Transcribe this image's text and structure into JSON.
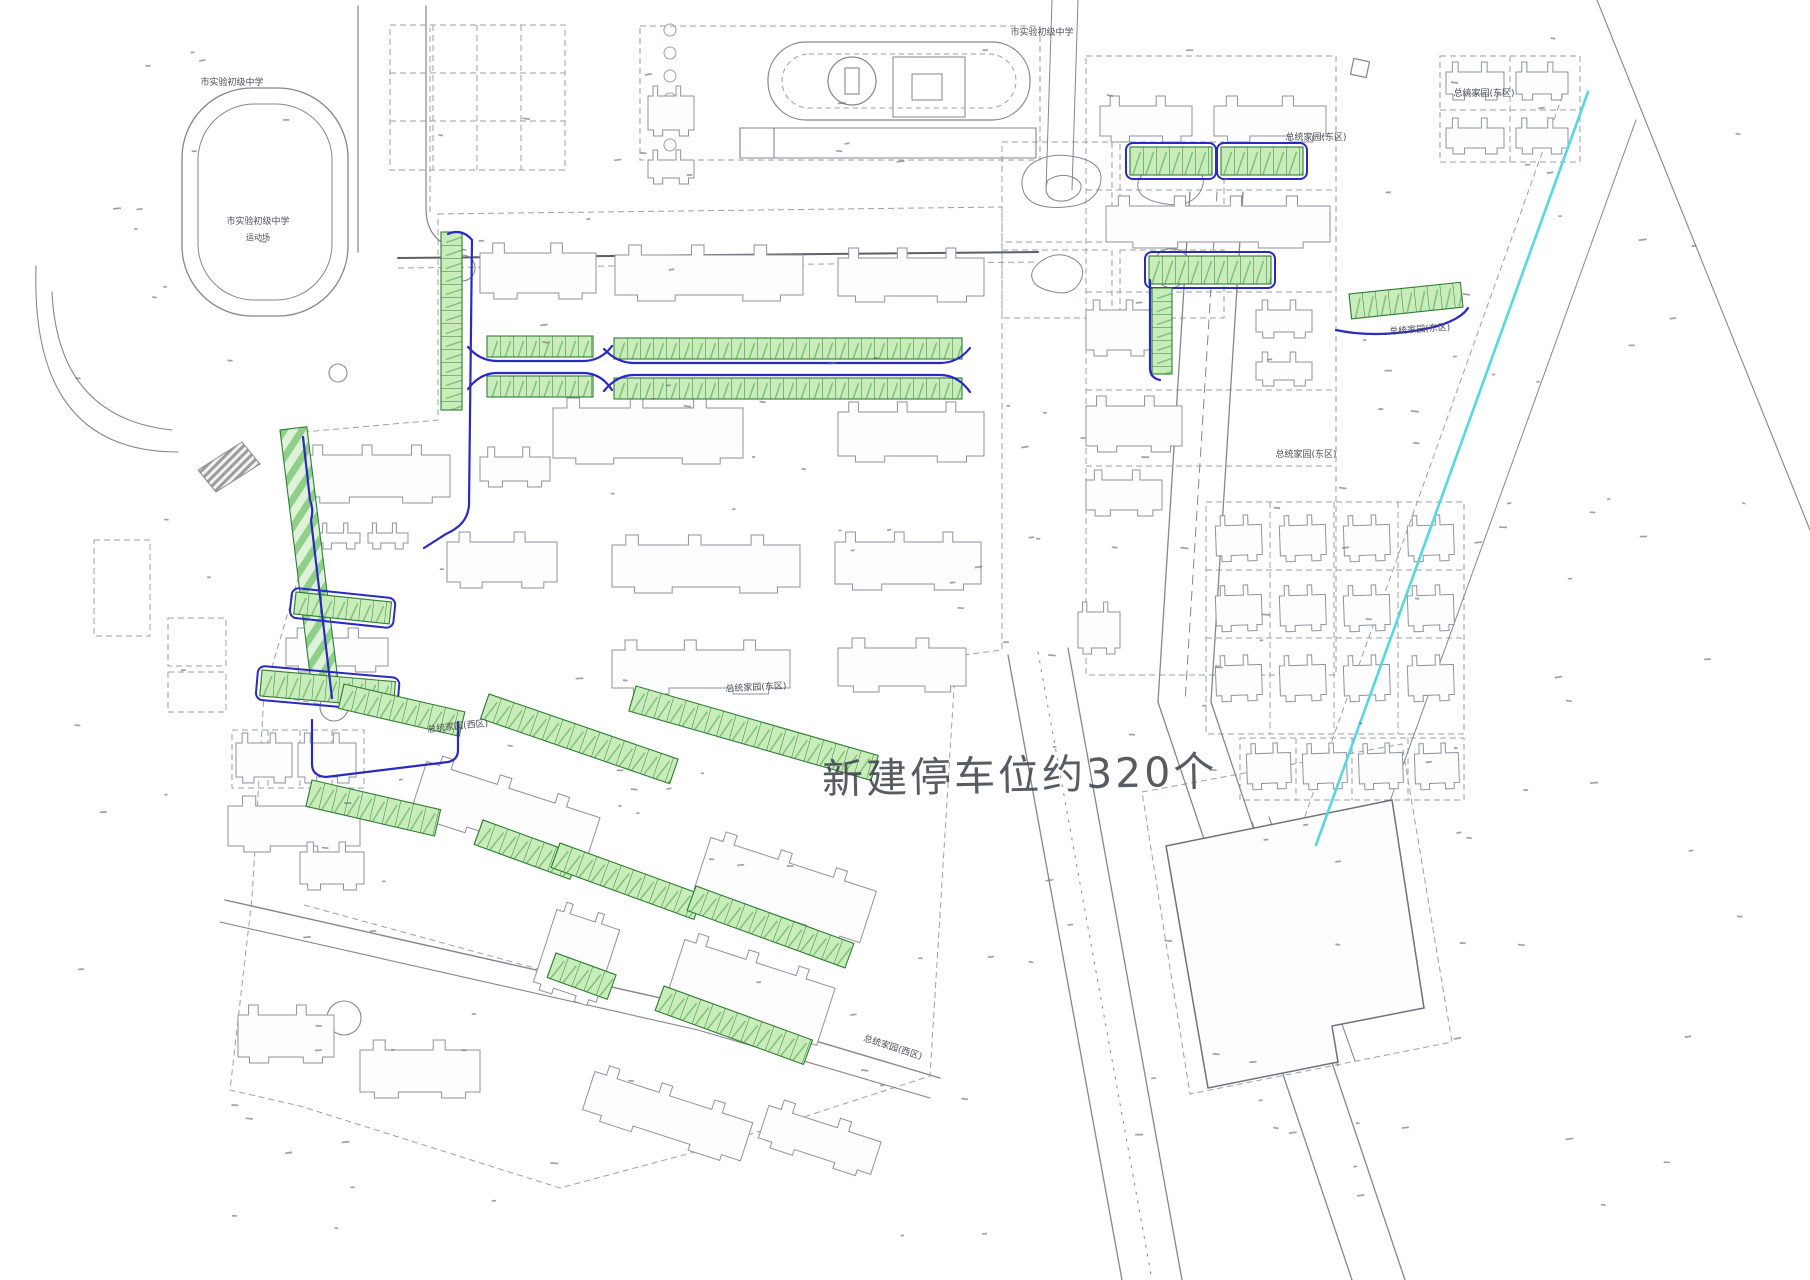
{
  "title": "新建停车位平面布置图",
  "annotation": {
    "text": "新建停车位约320个",
    "approx_new_parking_spaces": 320
  },
  "colors": {
    "parking_fill": "#c9ecbb",
    "parking_stroke": "#2f7d35",
    "parking_stripe": "#8fcf8a",
    "road_blue": "#2a2ac0",
    "river_cyan": "#57d8de",
    "line_gray": "#85878f",
    "parcel_gray": "#9aa0ac",
    "dark_gray": "#5d5f66",
    "label_color": "#4a4d55"
  },
  "river_line": {
    "x1": 1588,
    "y1": 92,
    "x2": 1316,
    "y2": 845
  },
  "labels": [
    {
      "text": "市实验初级中学",
      "x": 232,
      "y": 85,
      "size": 9,
      "rotate": 0
    },
    {
      "text": "市实验初级中学",
      "x": 258,
      "y": 224,
      "size": 9,
      "rotate": 0
    },
    {
      "text": "运动场",
      "x": 258,
      "y": 240,
      "size": 8,
      "rotate": 0
    },
    {
      "text": "市实验初级中学",
      "x": 1042,
      "y": 35,
      "size": 9,
      "rotate": 0
    },
    {
      "text": "总统家园(东区)",
      "x": 1484,
      "y": 96,
      "size": 9,
      "rotate": 0
    },
    {
      "text": "总统家园(东区)",
      "x": 1316,
      "y": 140,
      "size": 9,
      "rotate": 0
    },
    {
      "text": "总统家园(东区)",
      "x": 756,
      "y": 690,
      "size": 9,
      "rotate": -3
    },
    {
      "text": "总统家园(西区)",
      "x": 458,
      "y": 729,
      "size": 9,
      "rotate": -6
    },
    {
      "text": "总统家园(东区)",
      "x": 1306,
      "y": 457,
      "size": 9,
      "rotate": 0
    },
    {
      "text": "总统家园(东区)",
      "x": 1420,
      "y": 332,
      "size": 9,
      "rotate": -4
    },
    {
      "text": "总统家园(西区)",
      "x": 892,
      "y": 1050,
      "size": 9,
      "rotate": 18
    }
  ],
  "parking": {
    "stall_width_px": 13,
    "rows": [
      {
        "x": 441,
        "y": 232,
        "w": 21,
        "h": 178,
        "a": 0,
        "v": true
      },
      {
        "x": 280,
        "y": 430,
        "w": 27,
        "h": 272,
        "a": -7,
        "stripe": true
      },
      {
        "x": 296,
        "y": 592,
        "w": 96,
        "h": 22,
        "a": 6,
        "blue": true
      },
      {
        "x": 262,
        "y": 670,
        "w": 134,
        "h": 26,
        "a": 5,
        "blue": true
      },
      {
        "x": 344,
        "y": 684,
        "w": 124,
        "h": 25,
        "a": 13
      },
      {
        "x": 312,
        "y": 780,
        "w": 132,
        "h": 27,
        "a": 13
      },
      {
        "x": 483,
        "y": 820,
        "w": 102,
        "h": 26,
        "a": 20
      },
      {
        "x": 487,
        "y": 336,
        "w": 106,
        "h": 21,
        "a": 0
      },
      {
        "x": 487,
        "y": 376,
        "w": 106,
        "h": 21,
        "a": 0
      },
      {
        "x": 614,
        "y": 338,
        "w": 348,
        "h": 21,
        "a": 0
      },
      {
        "x": 614,
        "y": 378,
        "w": 348,
        "h": 21,
        "a": 0
      },
      {
        "x": 489,
        "y": 694,
        "w": 200,
        "h": 26,
        "a": 19
      },
      {
        "x": 636,
        "y": 686,
        "w": 252,
        "h": 26,
        "a": 16
      },
      {
        "x": 560,
        "y": 843,
        "w": 152,
        "h": 26,
        "a": 20
      },
      {
        "x": 696,
        "y": 886,
        "w": 168,
        "h": 26,
        "a": 20
      },
      {
        "x": 556,
        "y": 953,
        "w": 64,
        "h": 26,
        "a": 20
      },
      {
        "x": 664,
        "y": 986,
        "w": 158,
        "h": 26,
        "a": 20
      },
      {
        "x": 1130,
        "y": 147,
        "w": 82,
        "h": 28,
        "a": 0,
        "blue": true
      },
      {
        "x": 1221,
        "y": 147,
        "w": 82,
        "h": 28,
        "a": 0,
        "blue": true
      },
      {
        "x": 1149,
        "y": 256,
        "w": 122,
        "h": 28,
        "a": 0,
        "blue": true
      },
      {
        "x": 1152,
        "y": 288,
        "w": 20,
        "h": 86,
        "a": 0,
        "v": true
      },
      {
        "x": 1349,
        "y": 294,
        "w": 112,
        "h": 25,
        "a": -6
      }
    ]
  }
}
